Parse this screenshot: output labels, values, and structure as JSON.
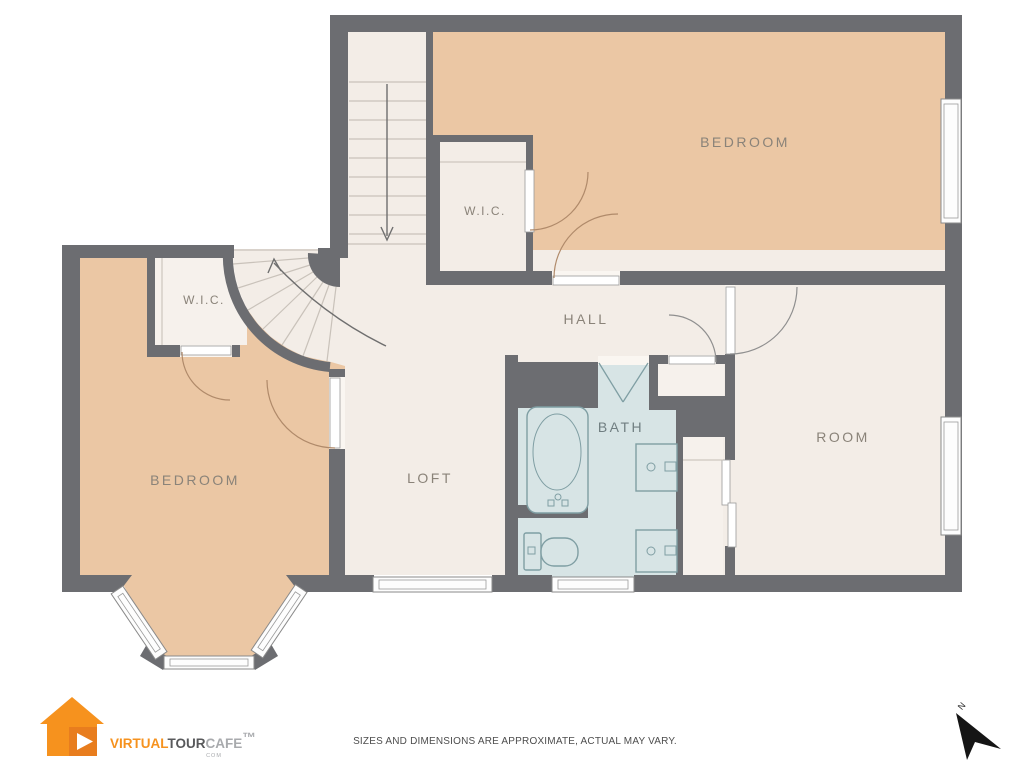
{
  "rooms": {
    "bedroom_top": "BEDROOM",
    "wic_top": "W.I.C.",
    "hall": "HALL",
    "wic_left": "W.I.C.",
    "bedroom_left": "BEDROOM",
    "loft": "LOFT",
    "bath": "BATH",
    "room": "ROOM"
  },
  "compass": {
    "label": "N"
  },
  "footer": {
    "disclaimer": "SIZES AND DIMENSIONS ARE APPROXIMATE, ACTUAL MAY VARY."
  },
  "logo": {
    "virtual": "VIRTUAL",
    "tour": "TOUR",
    "cafe": "CAFE",
    "tld": "COM",
    "tm": "™"
  },
  "colors": {
    "wall": "#6c6d71",
    "floor": "#f3ede7",
    "room_peach": "#ebc7a4",
    "bath_blue": "#d7e4e5",
    "door_arc_warm": "#b08a6a",
    "logo_orange": "#f6921e",
    "logo_dark_gray": "#58595b",
    "logo_light_gray": "#a8aaad"
  }
}
